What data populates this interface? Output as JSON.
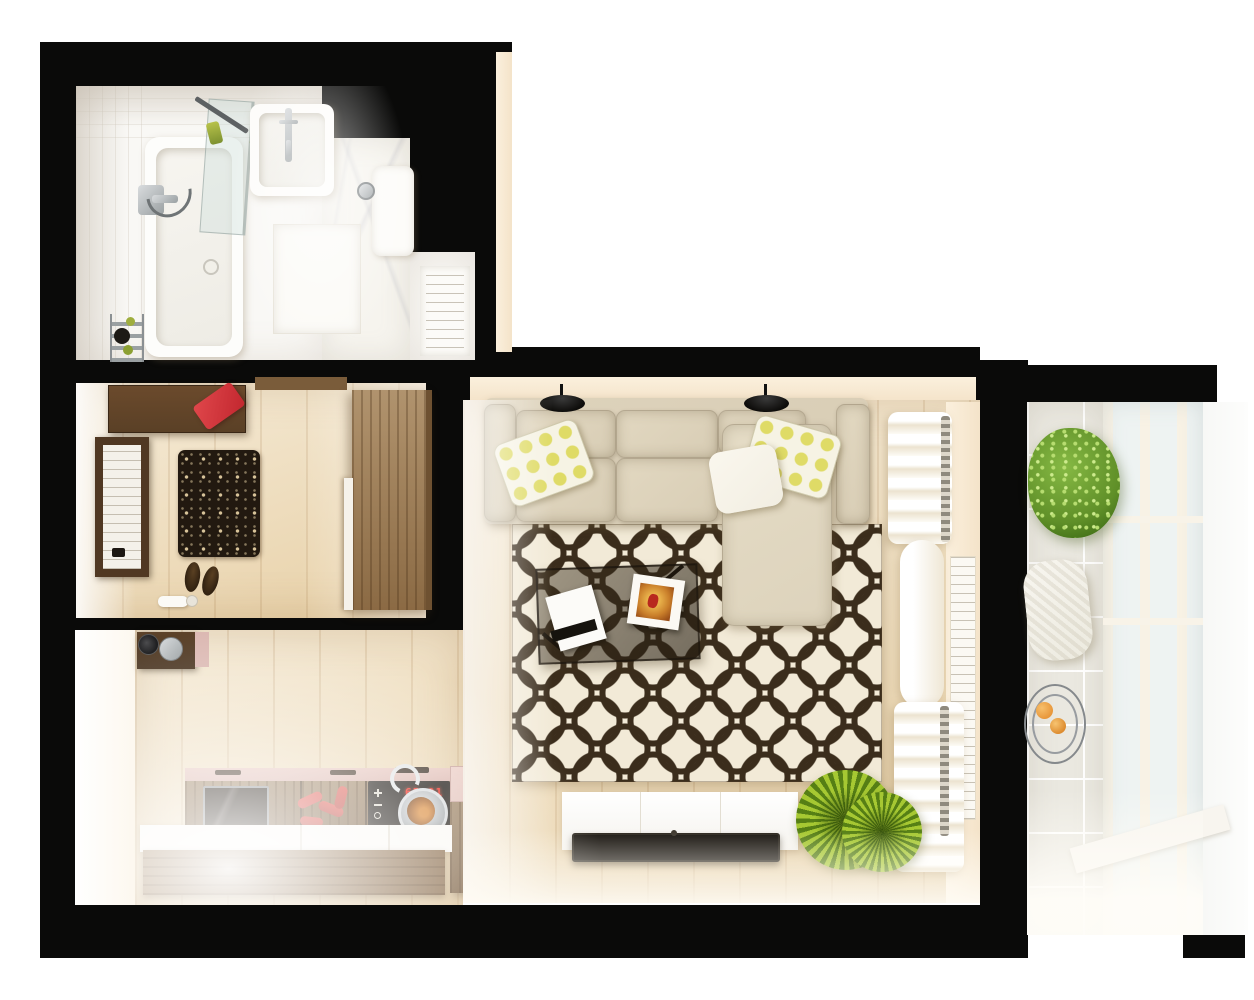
{
  "scene": {
    "description": "Top-down 3D render of a small studio apartment floor plan",
    "view": "bird's eye",
    "rooms": [
      "bathroom",
      "hallway",
      "kitchen",
      "living-room",
      "balcony"
    ]
  },
  "kitchen": {
    "cooktop_display": "65:91",
    "objects": [
      "coffee-shelf",
      "oven",
      "cabinet-row",
      "chili-peppers",
      "induction-cooktop",
      "frying-pan",
      "kitchen-island",
      "white-countertop"
    ]
  },
  "bathroom": {
    "objects": [
      "bathtub",
      "shower-glass-screen",
      "shower-mixer",
      "hand-shower-hose",
      "wash-basin",
      "faucet",
      "toiletries",
      "toilet",
      "towel-rack",
      "bathroom-door",
      "marble-floor"
    ]
  },
  "hallway": {
    "objects": [
      "console-table",
      "red-bag",
      "entrance-door",
      "ornamental-rug",
      "shoes",
      "wardrobe",
      "cosmetics"
    ]
  },
  "living_room": {
    "objects": [
      "sectional-sofa",
      "chaise-lounge",
      "polka-dot-pillows",
      "white-pillow",
      "wall-lamps",
      "circle-pattern-rug",
      "smoked-glass-coffee-table",
      "white-notebook",
      "magazine",
      "curtains",
      "balcony-window",
      "tv-sideboard",
      "tv",
      "spiky-plant"
    ]
  },
  "balcony": {
    "objects": [
      "leafy-plant",
      "wicker-pouf",
      "wire-side-table",
      "oranges",
      "glazed-window-wall",
      "tile-floor"
    ]
  },
  "colors": {
    "background": "#ffffff",
    "wall": "#0a0a09",
    "wall_face": "#f4e3c9",
    "wood_floor": "#ecd8b2",
    "wood_island": "#8d6c48",
    "wardrobe_wood": "#96744c",
    "console_wood": "#5a4026",
    "sofa_cushion": "#d8cdb5",
    "chaise": "#ddd3bc",
    "pillow_dot": "#dfdb66",
    "pillow_white": "#f2eee2",
    "rug_cream": "#f2ead7",
    "rug_ring": "#3b2d1c",
    "hall_rug": "#221910",
    "counter_pink": "#dcb8b0",
    "countertop_white": "#faf8f4",
    "cooktop_black": "#15100b",
    "led_red": "#ff2418",
    "pepper_red": "#d6534c",
    "tv_black": "#17130e",
    "bench_white": "#f5f3ee",
    "plant_spiky": "#a6c832",
    "plant_bush": "#5f8f28",
    "balcony_tile": "#eae8e0",
    "glass_blue": "#eef3f2",
    "curtain_white": "#fdfbf5",
    "marble": "#f6f4ee",
    "chrome": "#9aa0a2",
    "orange_fruit": "#e8973b",
    "bag_red": "#c2272f"
  }
}
